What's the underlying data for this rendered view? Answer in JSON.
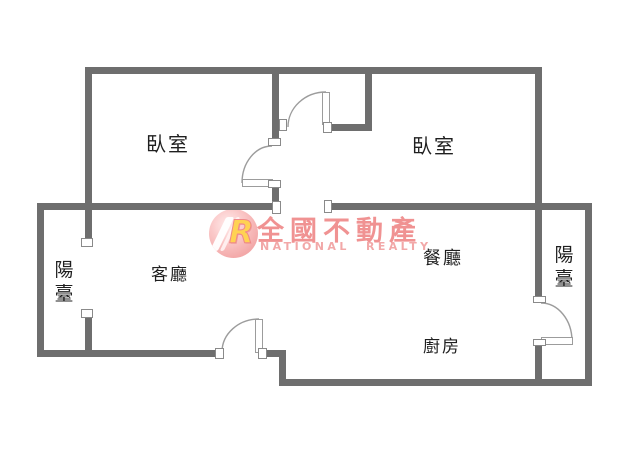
{
  "plan": {
    "rooms": {
      "bedroom_left": "臥室",
      "bedroom_right": "臥室",
      "living_room": "客廳",
      "dining_room": "餐廳",
      "kitchen": "廚房",
      "balcony_left": {
        "char_top": "陽",
        "char_bottom": "臺"
      },
      "balcony_right": {
        "char_top": "陽",
        "char_bottom": "臺"
      }
    }
  },
  "watermark": {
    "logo_letter": "R",
    "brand_zh": "全國不動產",
    "brand_en": "NATIONAL REALTY",
    "brand_color": "#f09292",
    "logo_color": "#f3a6a6"
  },
  "colors": {
    "wall": "#6e6e6e",
    "door_line": "#9c9c9c",
    "label_text": "#1f1f1f",
    "background": "#ffffff"
  }
}
